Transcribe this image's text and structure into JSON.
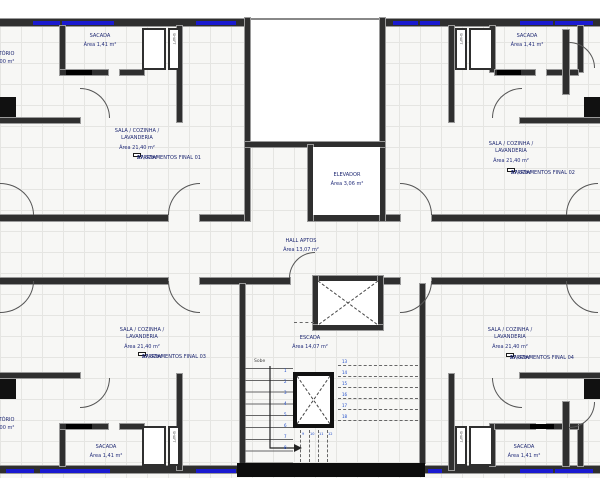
{
  "colors": {
    "wall": "#2f2f2f",
    "window_marker": "#1a1ad0",
    "label_text": "#1c2670",
    "grid_line": "#e5e5e2",
    "stair_core_wall": "#0d0d0d"
  },
  "units": {
    "top_left": {
      "sala_line1": "SALA / COZINHA /",
      "sala_line2": "LAVANDERIA",
      "sala_area": "Área 21,40 m²",
      "apto": "APARTAMENTOS FINAL 01",
      "apto_area": "57,32m²",
      "sacada": "SACADA",
      "sacada_area": "Área 1,41 m²"
    },
    "top_right": {
      "sala_line1": "SALA / COZINHA /",
      "sala_line2": "LAVANDERIA",
      "sala_area": "Área 21,40 m²",
      "apto": "APARTAMENTOS FINAL 02",
      "apto_area": "57,32m²",
      "sacada": "SACADA",
      "sacada_area": "Área 1,41 m²"
    },
    "bottom_left": {
      "sala_line1": "SALA / COZINHA /",
      "sala_line2": "LAVANDERIA",
      "sala_area": "Área 21,40 m²",
      "apto": "APARTAMENTOS FINAL 03",
      "apto_area": "57,32m²",
      "sacada": "SACADA",
      "sacada_area": "Área 1,41 m²"
    },
    "bottom_right": {
      "sala_line1": "SALA / COZINHA /",
      "sala_line2": "LAVANDERIA",
      "sala_area": "Área 21,40 m²",
      "apto": "APARTAMENTOS FINAL 04",
      "apto_area": "57,32m²",
      "sacada": "SACADA",
      "sacada_area": "Área 1,41 m²"
    }
  },
  "core": {
    "elevador": {
      "label": "ELEVADOR",
      "area": "Área 3,06 m²"
    },
    "hall": {
      "label": "HALL APTOS",
      "area": "Área 13,07 m²"
    },
    "escada": {
      "label": "ESCADA",
      "area": "Área 14,07 m²",
      "sobe": "Sobe"
    },
    "shaft_label": "SHAFT"
  },
  "stairs": {
    "left_steps": [
      "1",
      "2",
      "3",
      "4",
      "5",
      "6",
      "7",
      "8"
    ],
    "mid_steps": [
      "9",
      "10",
      "11",
      "12"
    ],
    "right_steps": [
      "13",
      "14",
      "15",
      "16",
      "17",
      "18"
    ]
  },
  "edges": {
    "dormitorio": "DORMITÓRIO",
    "dormitorio_area": "Área 7,00 m²"
  }
}
